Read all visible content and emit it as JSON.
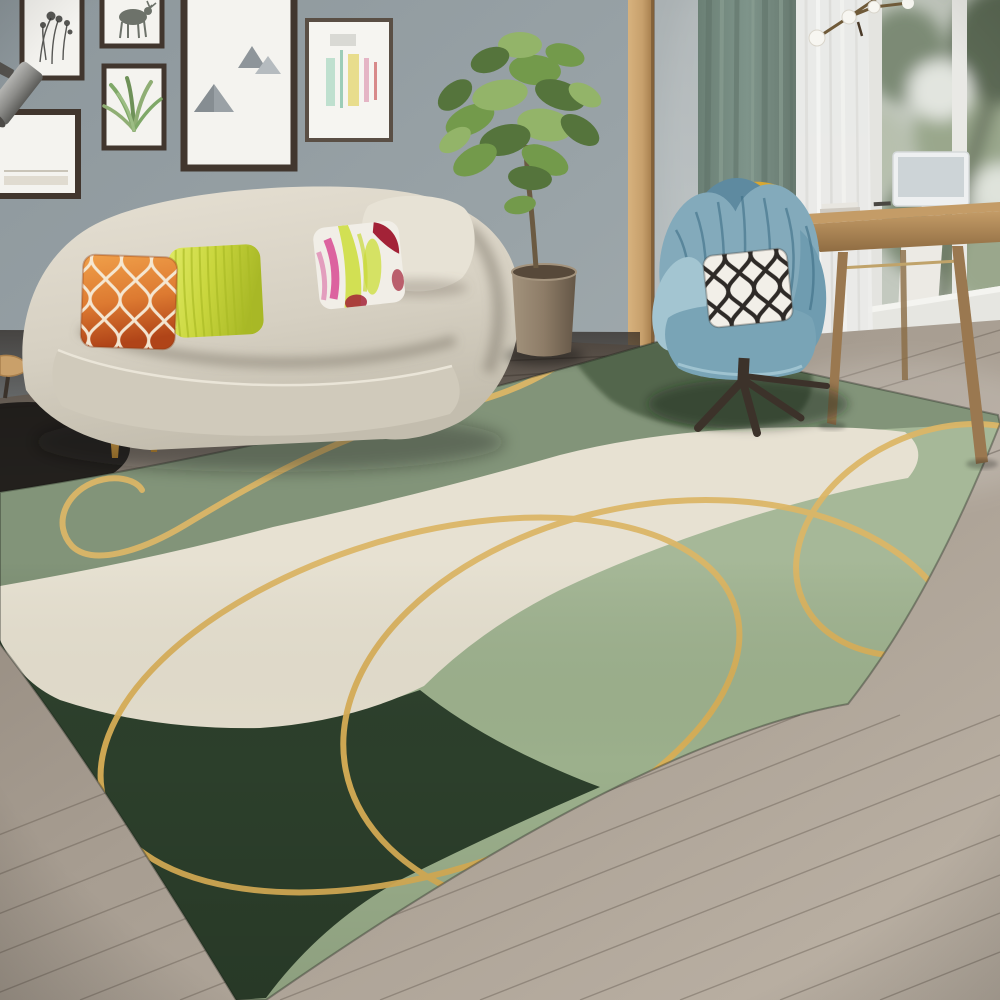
{
  "scene": {
    "type": "interior-photograph",
    "room": "living-room",
    "objects": [
      "gallery-wall-frames",
      "wall-spotlight",
      "flower-sketch-art",
      "deer-sketch-art",
      "aloe-sketch-art",
      "triangle-art",
      "pastel-abstract-art",
      "landscape-art",
      "green-curtain",
      "sheer-curtain",
      "window-with-greenery",
      "branch-pendant-light",
      "wood-door-trim",
      "cream-curved-sofa",
      "orange-moroccan-pillow",
      "chartreuse-pillow",
      "abstract-watercolor-pillow",
      "cream-back-cushion",
      "gold-sofa-legs",
      "fiddle-leaf-fig-plant",
      "brown-cylinder-planter",
      "blue-tufted-swivel-armchair",
      "black-white-trellis-pillow",
      "yellow-throw",
      "dark-wood-chair-legs",
      "wood-writing-desk",
      "white-monitor",
      "books",
      "gray-wood-plank-floor",
      "black-side-table",
      "green-abstract-area-rug-with-gold-lines"
    ],
    "rug": {
      "style": "abstract wavy color-block",
      "zones": [
        "medium-green",
        "dark-green-top-patch",
        "cream-wave-band",
        "light-sage-band",
        "dark-forest-corner"
      ],
      "accent": "gold curved lines and loops"
    }
  },
  "palette": {
    "wall-left": "#96a0a4",
    "wall-right": "#b2b9bb",
    "trim": "#c7a06c",
    "trim-dark": "#a8814f",
    "curtain": "#768b80",
    "curtain-dark": "#5f7268",
    "curtain-light": "#8ea396",
    "sheer": "#ededeb",
    "window-base": "#c3c9bf",
    "foliage-dark": "#5c6b55",
    "foliage-mid": "#7c8a74",
    "foliage-light": "#9aa78c",
    "sky": "#e2e5df",
    "frame": "#41362e",
    "mat": "#f4f3ef",
    "metal": "#8e8e8b",
    "floor-light": "#b3a99d",
    "floor-mid": "#a0968a",
    "floor-dark": "#3c342e",
    "plank": "#7d7468",
    "rug-green": "#74886a",
    "rug-dark-patch": "#415538",
    "rug-cream": "#e4decd",
    "rug-sage": "#9cb08c",
    "rug-dark-corner": "#2c3f2b",
    "rug-gold": "#d8ae56",
    "sofa": "#d8d2c4",
    "sofa-shadow": "#bcb6a8",
    "sofa-leg": "#bd9750",
    "pillow-orange": "#dd7a31",
    "pillow-orange-deep": "#b84c1d",
    "pillow-lattice": "#f6ecd9",
    "pillow-chartreuse": "#c9d63d",
    "pillow-chartreuse-dark": "#a9ba26",
    "pillow-white": "#f1eee7",
    "pillow-pink": "#d84a92",
    "pillow-crimson": "#a32237",
    "pillow-lime": "#cede43",
    "chair-blue": "#83aabb",
    "chair-blue-dark": "#5e8aa0",
    "chair-blue-light": "#a3c5d1",
    "throw-yellow": "#d9a832",
    "bw-pillow": "#f2efe8",
    "bw-pattern": "#2e2a27",
    "chair-leg": "#3c322a",
    "desk-wood": "#b08a58",
    "desk-wood-dark": "#97744a",
    "desk-leg": "#9a7850",
    "monitor": "#eef0f1",
    "screen": "#cdd4d7",
    "pot": "#8d7c67",
    "pot-dark": "#6e604f",
    "soil": "#57493a",
    "leaf-dark": "#55743c",
    "leaf-mid": "#739a4b",
    "leaf-light": "#93b469",
    "bulb": "#f7f6f1",
    "branch": "#6f5a39",
    "table-top": "#c9a06a",
    "table-base": "#1b1917"
  }
}
